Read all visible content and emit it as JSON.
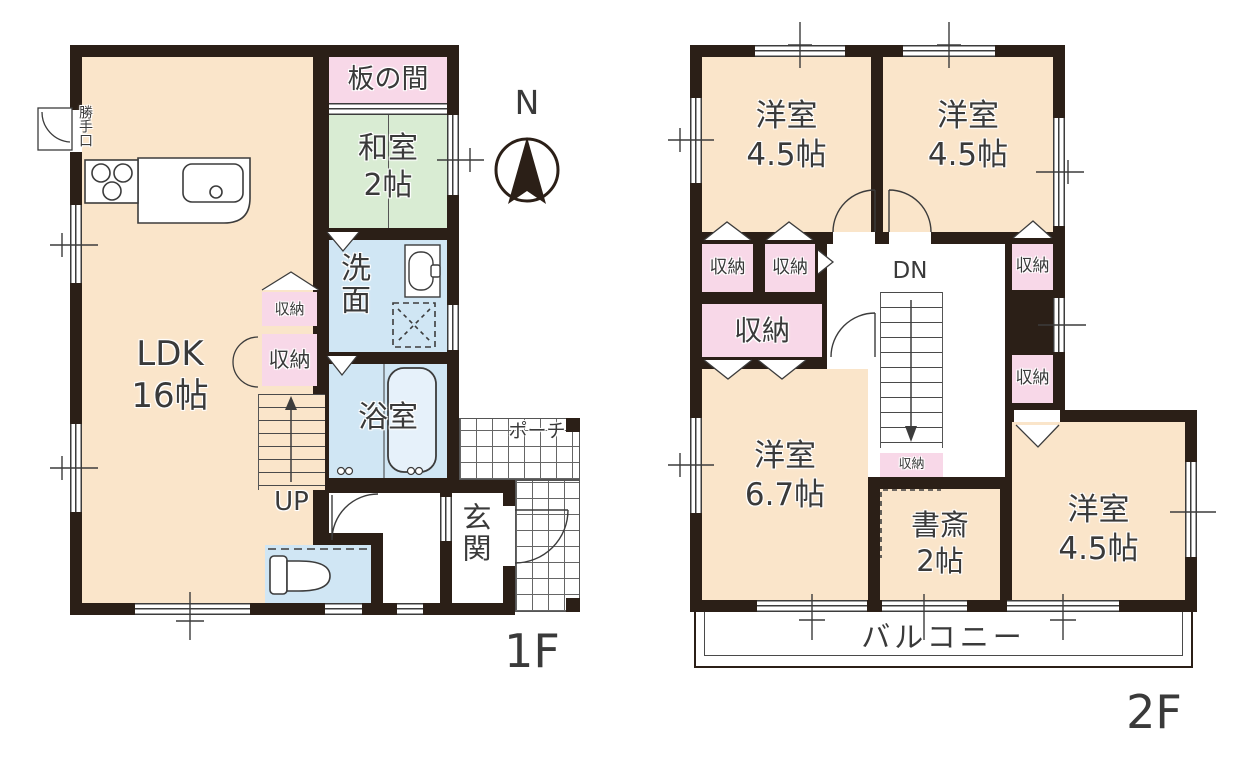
{
  "compass": {
    "north_label": "N"
  },
  "floor1": {
    "floor_label": "1F",
    "ldk": {
      "name": "LDK",
      "size": "16帖"
    },
    "itanoma": {
      "name": "板の間"
    },
    "washitsu": {
      "name": "和室",
      "size": "2帖"
    },
    "senmen": {
      "name": "洗面"
    },
    "bathroom": {
      "name": "浴室"
    },
    "closet_upper": {
      "name": "収納"
    },
    "closet_lower": {
      "name": "収納"
    },
    "stairs": {
      "label": "UP"
    },
    "entrance": {
      "name": "玄関"
    },
    "porch": {
      "name": "ポーチ"
    },
    "back_door": {
      "name": "勝手口"
    }
  },
  "floor2": {
    "floor_label": "2F",
    "bedroom_nw": {
      "name": "洋室",
      "size": "4.5帖"
    },
    "bedroom_ne": {
      "name": "洋室",
      "size": "4.5帖"
    },
    "bedroom_w": {
      "name": "洋室",
      "size": "6.7帖"
    },
    "bedroom_se": {
      "name": "洋室",
      "size": "4.5帖"
    },
    "study": {
      "name": "書斎",
      "size": "2帖"
    },
    "closet_nw_left": {
      "name": "収納"
    },
    "closet_nw_right": {
      "name": "収納"
    },
    "closet_w_large": {
      "name": "収納"
    },
    "closet_ne": {
      "name": "収納"
    },
    "closet_e": {
      "name": "収納"
    },
    "closet_stairs": {
      "name": "収納"
    },
    "stairs": {
      "label": "DN"
    },
    "balcony": {
      "name": "バルコニー"
    }
  },
  "colors": {
    "wall": "#2b1f17",
    "western_room": "#fae5ca",
    "tatami_room": "#d9ecd3",
    "storage_pink": "#f8d8e8",
    "wet_area_blue": "#d0e6f4",
    "line": "#3c3c3c"
  }
}
